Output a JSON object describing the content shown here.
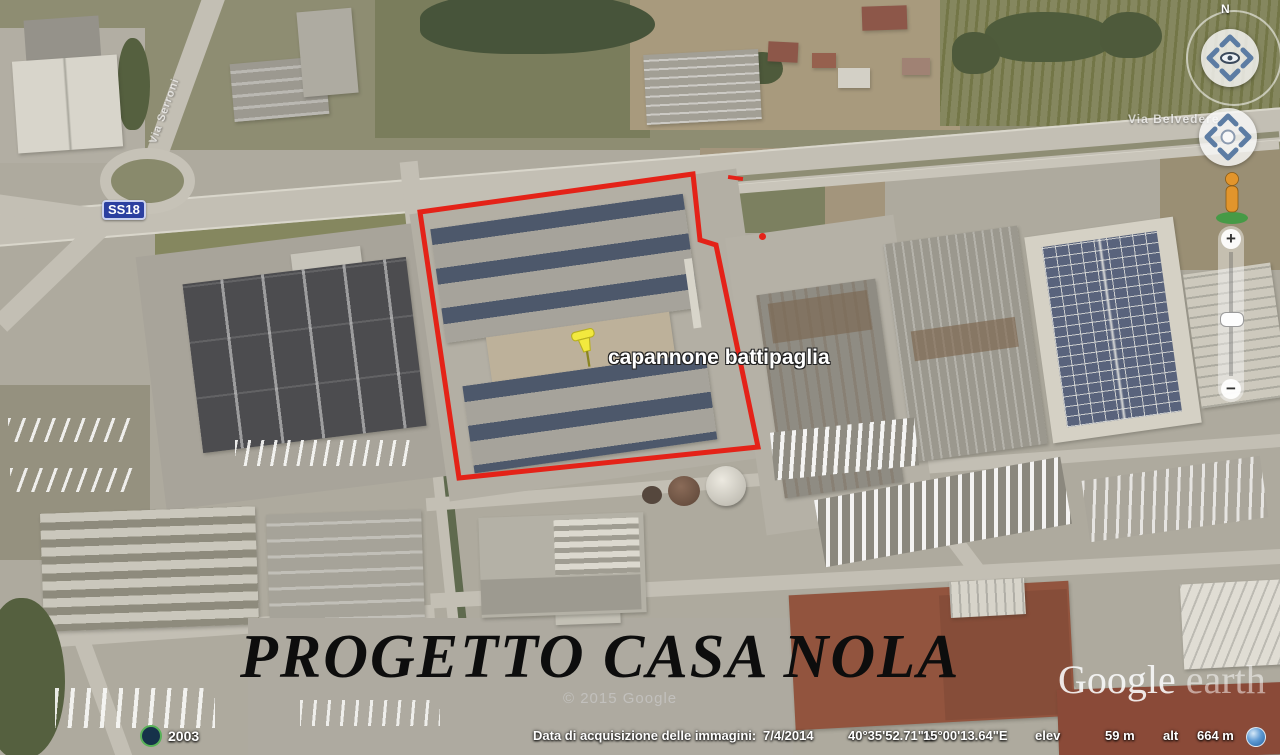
{
  "placemark": {
    "label": "capannone battipaglia"
  },
  "roads": {
    "shield": "SS18",
    "top_label": "Via Serroni",
    "right_label": "Via Belvedere"
  },
  "overlay": {
    "project_title": "PROGETTO CASA NOLA",
    "copyright": "© 2015 Google",
    "watermark_word1": "Google",
    "watermark_word2": " earth"
  },
  "nav": {
    "north": "N",
    "zoom_in_label": "+",
    "zoom_out_label": "−"
  },
  "status_bar": {
    "imagery_label": "Data di acquisizione delle immagini:",
    "imagery_date": "7/4/2014",
    "latitude": "40°35'52.71\"N",
    "longitude": "15°00'13.64\"E",
    "elevation_label": "elev",
    "elevation_value": "59 m",
    "altitude_label": "alt",
    "altitude_value": "664 m",
    "history_year": "2003"
  },
  "colors": {
    "boundary_red": "#e42218",
    "pin_yellow": "#f2e93e",
    "shield_blue": "#2b3fa0",
    "solar_roof": "#4d586b",
    "terracotta_roof": "#92543e"
  }
}
